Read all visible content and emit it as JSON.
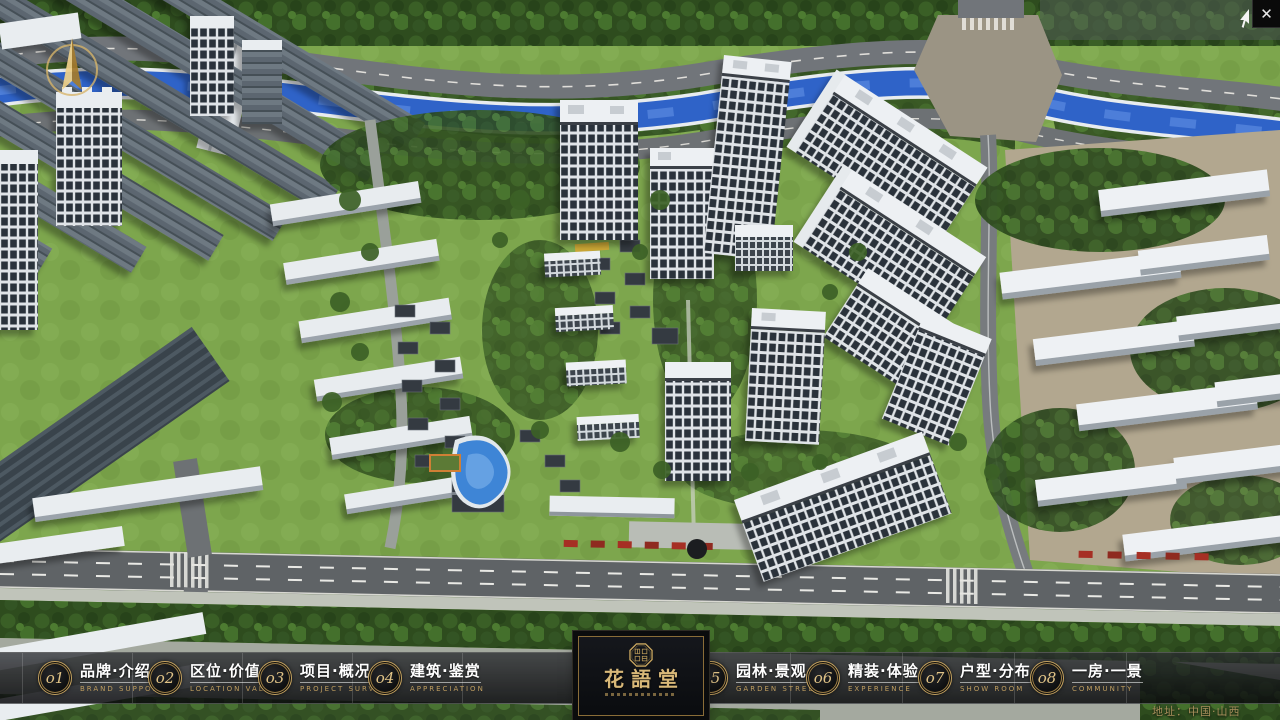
{
  "window": {
    "close_glyph": "✕"
  },
  "nav": {
    "items": [
      {
        "num": "o1",
        "zh": "品牌·介绍",
        "en": "BRAND SUPPORT"
      },
      {
        "num": "o2",
        "zh": "区位·价值",
        "en": "LOCATION VALUE"
      },
      {
        "num": "o3",
        "zh": "项目·概况",
        "en": "PROJECT SURVEY"
      },
      {
        "num": "o4",
        "zh": "建筑·鉴赏",
        "en": "APPRECIATION"
      },
      {
        "num": "o5",
        "zh": "园林·景观",
        "en": "GARDEN STREET"
      },
      {
        "num": "o6",
        "zh": "精装·体验",
        "en": "EXPERIENCE"
      },
      {
        "num": "o7",
        "zh": "户型·分布",
        "en": "SHOW ROOM"
      },
      {
        "num": "o8",
        "zh": "一房·一景",
        "en": "COMMUNITY"
      }
    ]
  },
  "logo": {
    "title": "花語堂"
  },
  "footer": {
    "address": "地址：中国·山西"
  },
  "colors": {
    "gold": "#c9a563",
    "gold_light": "#e0c387",
    "bar_bg": "rgba(13,14,17,0.82)",
    "river_blue": "#2f63c8",
    "lawn_green": "#7da64d",
    "forest_green": "#2e4c1e"
  }
}
